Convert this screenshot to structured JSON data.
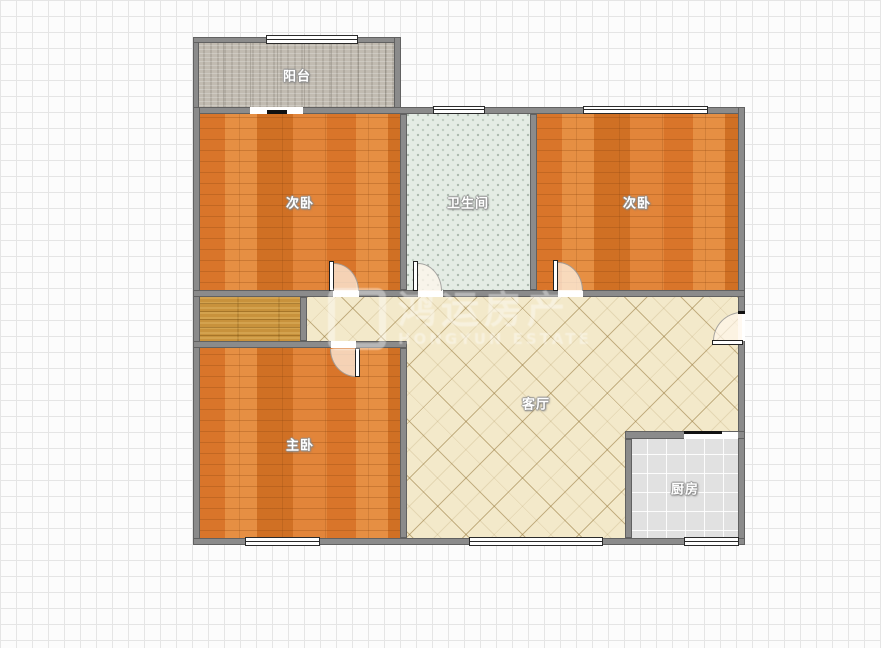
{
  "floorplan": {
    "rooms": {
      "balcony": {
        "label": "阳台",
        "floor": "gray-speckle-tile"
      },
      "bedroom_left": {
        "label": "次卧",
        "floor": "orange-wood-plank"
      },
      "bathroom": {
        "label": "卫生间",
        "floor": "pale-green-mosaic-tile"
      },
      "bedroom_right": {
        "label": "次卧",
        "floor": "orange-wood-plank"
      },
      "closet": {
        "label": "",
        "floor": "golden-wood-plank"
      },
      "master_bedroom": {
        "label": "主卧",
        "floor": "orange-wood-plank"
      },
      "living_room": {
        "label": "客厅",
        "floor": "cream-diagonal-tile"
      },
      "kitchen": {
        "label": "厨房",
        "floor": "light-gray-grid-tile"
      }
    },
    "watermark": {
      "line1": "鸿运房产",
      "line2": "HONGYUN ESTATE"
    },
    "features": {
      "swing_doors": 5,
      "windows": 6,
      "balcony_sliding_door": 1,
      "kitchen_wall_opening": 1,
      "entry_door_side": "right"
    },
    "colors": {
      "background": "#fcfcfc",
      "grid_line": "#e5e5e5",
      "wall_fill": "#8b8b8b",
      "wall_edge": "#616161",
      "wood_floor": "#dd8134",
      "closet_wood": "#c8923c",
      "bathroom_tile": "#e4ece4",
      "balcony_floor": "#c1bbb1",
      "living_tile": "#f3e9ca",
      "kitchen_tile": "#e1e1e1",
      "label_text": "#ffffff"
    }
  }
}
